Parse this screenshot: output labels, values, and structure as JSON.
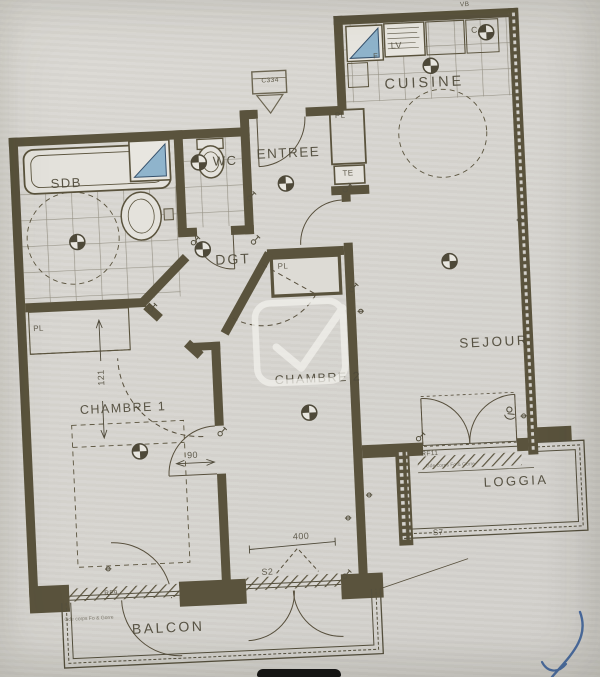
{
  "rooms": {
    "sdb": "SDB",
    "wc": "WC",
    "entree": "ENTREE",
    "cuisine": "CUISINE",
    "dgt": "DGT",
    "chambre1": "CHAMBRE 1",
    "chambre2": "CHAMBRE 2",
    "sejour": "SEJOUR",
    "loggia": "LOGGIA",
    "balcon": "BALCON"
  },
  "labels": {
    "pl_entree": "PL",
    "te": "TE",
    "pl_chambre1": "PL",
    "pl_chambre2": "PL",
    "lv": "LV",
    "c": "C",
    "f": "F",
    "vb": "VB"
  },
  "dimensions": {
    "width_121": "121",
    "door_90": "90",
    "window_400": "400"
  },
  "codes": {
    "s2": "S2",
    "s7": "S7",
    "rf9": "RF9",
    "rf11": "RF11"
  },
  "stamp": {
    "code": "C334"
  },
  "annotations": {
    "balcon_note": "Gde corps Fo & Gorre",
    "loggia_note": "Gde corps Fo & Gorre"
  },
  "colors": {
    "paper": "#d8d6d2",
    "ink": "#5a533d",
    "tile_line": "#58523e",
    "fixture_fill": "#e4e2dc",
    "water_blue": "#8fb4cc",
    "signature_blue": "#40659f",
    "watermark": "#f2f1ec"
  }
}
